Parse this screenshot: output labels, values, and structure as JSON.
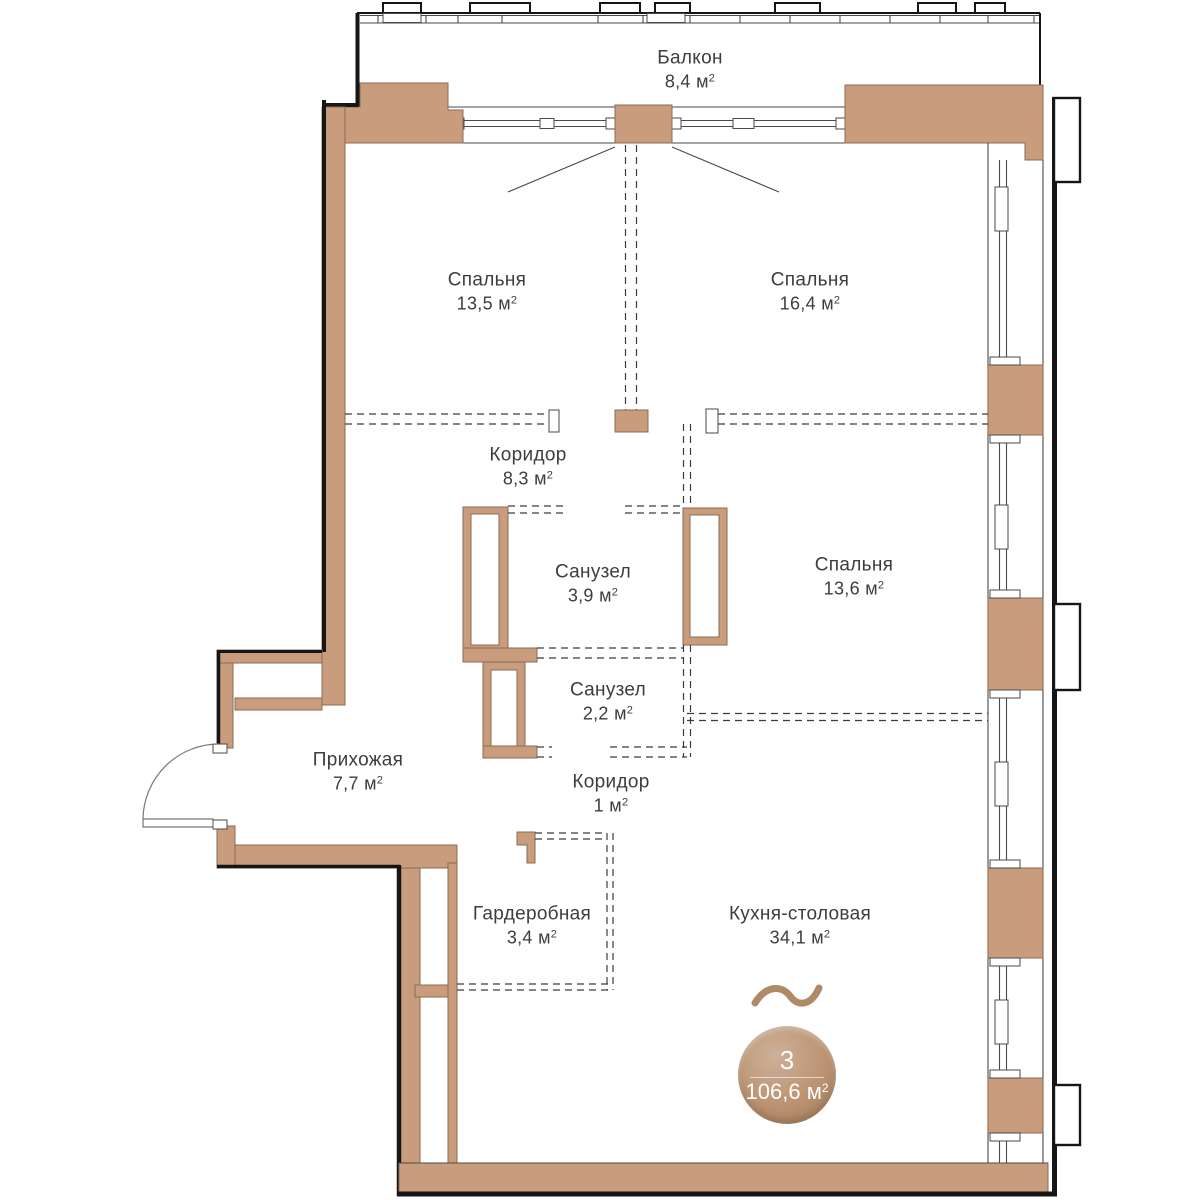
{
  "plan": {
    "unit": "м",
    "sup": "2",
    "rooms": [
      {
        "id": "balcony",
        "name": "Балкон",
        "area": "8,4"
      },
      {
        "id": "bedroom-1",
        "name": "Спальня",
        "area": "13,5"
      },
      {
        "id": "bedroom-2",
        "name": "Спальня",
        "area": "16,4"
      },
      {
        "id": "corridor-1",
        "name": "Коридор",
        "area": "8,3"
      },
      {
        "id": "bathroom-1",
        "name": "Санузел",
        "area": "3,9"
      },
      {
        "id": "bedroom-3",
        "name": "Спальня",
        "area": "13,6"
      },
      {
        "id": "bathroom-2",
        "name": "Санузел",
        "area": "2,2"
      },
      {
        "id": "hallway",
        "name": "Прихожая",
        "area": "7,7"
      },
      {
        "id": "corridor-2",
        "name": "Коридор",
        "area": "1"
      },
      {
        "id": "wardrobe",
        "name": "Гардеробная",
        "area": "3,4"
      },
      {
        "id": "kitchen",
        "name": "Кухня-столовая",
        "area": "34,1"
      }
    ],
    "badge": {
      "rooms_count": "3",
      "total_area": "106,6"
    },
    "colors": {
      "wall": "#C99C7E",
      "outline": "#161616",
      "badge_light": "#cdb197",
      "badge_dark": "#a57b55",
      "wave": "#b08a66",
      "text": "#3d3d3d"
    }
  }
}
